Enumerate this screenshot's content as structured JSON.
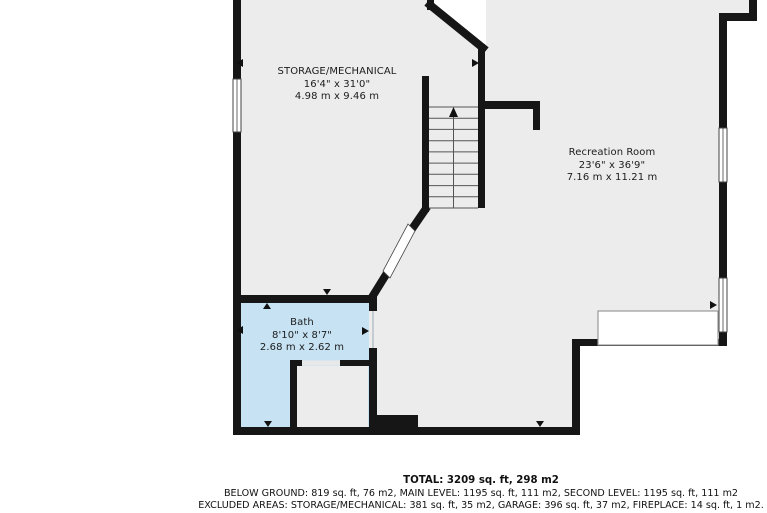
{
  "plan": {
    "colors": {
      "floor": "#ececec",
      "wall": "#161616",
      "bath_highlight": "#c6e2f3",
      "outside": "#ffffff"
    },
    "rooms": [
      {
        "name": "STORAGE/MECHANICAL",
        "dimensions_ft": "16'4\" x 31'0\"",
        "dimensions_m": "4.98 m x 9.46 m"
      },
      {
        "name": "Recreation Room",
        "dimensions_ft": "23'6\" x 36'9\"",
        "dimensions_m": "7.16 m x 11.21 m"
      },
      {
        "name": "Bath",
        "dimensions_ft": "8'10\" x 8'7\"",
        "dimensions_m": "2.68 m x 2.62 m"
      }
    ]
  },
  "footer": {
    "total": "TOTAL: 3209 sq. ft, 298 m2",
    "levels": "BELOW GROUND: 819 sq. ft, 76 m2, MAIN LEVEL: 1195 sq. ft, 111 m2, SECOND LEVEL: 1195 sq. ft, 111 m2",
    "excluded": "EXCLUDED AREAS: STORAGE/MECHANICAL: 381 sq. ft, 35 m2, GARAGE: 396 sq. ft, 37 m2, FIREPLACE: 14 sq. ft, 1 m2."
  }
}
